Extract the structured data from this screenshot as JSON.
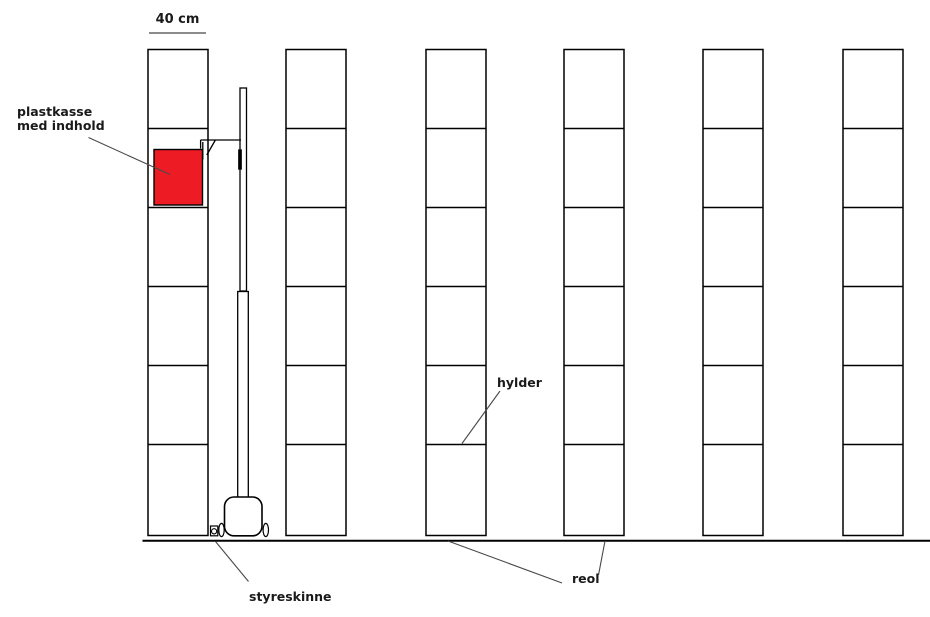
{
  "diagram": {
    "dimension": {
      "label": "40 cm"
    },
    "labels": {
      "box_line1": "plastkasse",
      "box_line2": "med indhold",
      "shelves": "hylder",
      "rack": "reol",
      "guide_rail": "styreskinne"
    },
    "structure": {
      "rack_count": 6,
      "shelf_rows_per_rack": 6,
      "box_location": {
        "rack_index_from_left": 1,
        "shelf_row_from_top": 2
      }
    },
    "colors": {
      "box_fill": "#ed1c24",
      "outline": "#000000",
      "leader_line": "#4a4a4a",
      "dimension_line": "#666666",
      "background": "#ffffff"
    }
  }
}
